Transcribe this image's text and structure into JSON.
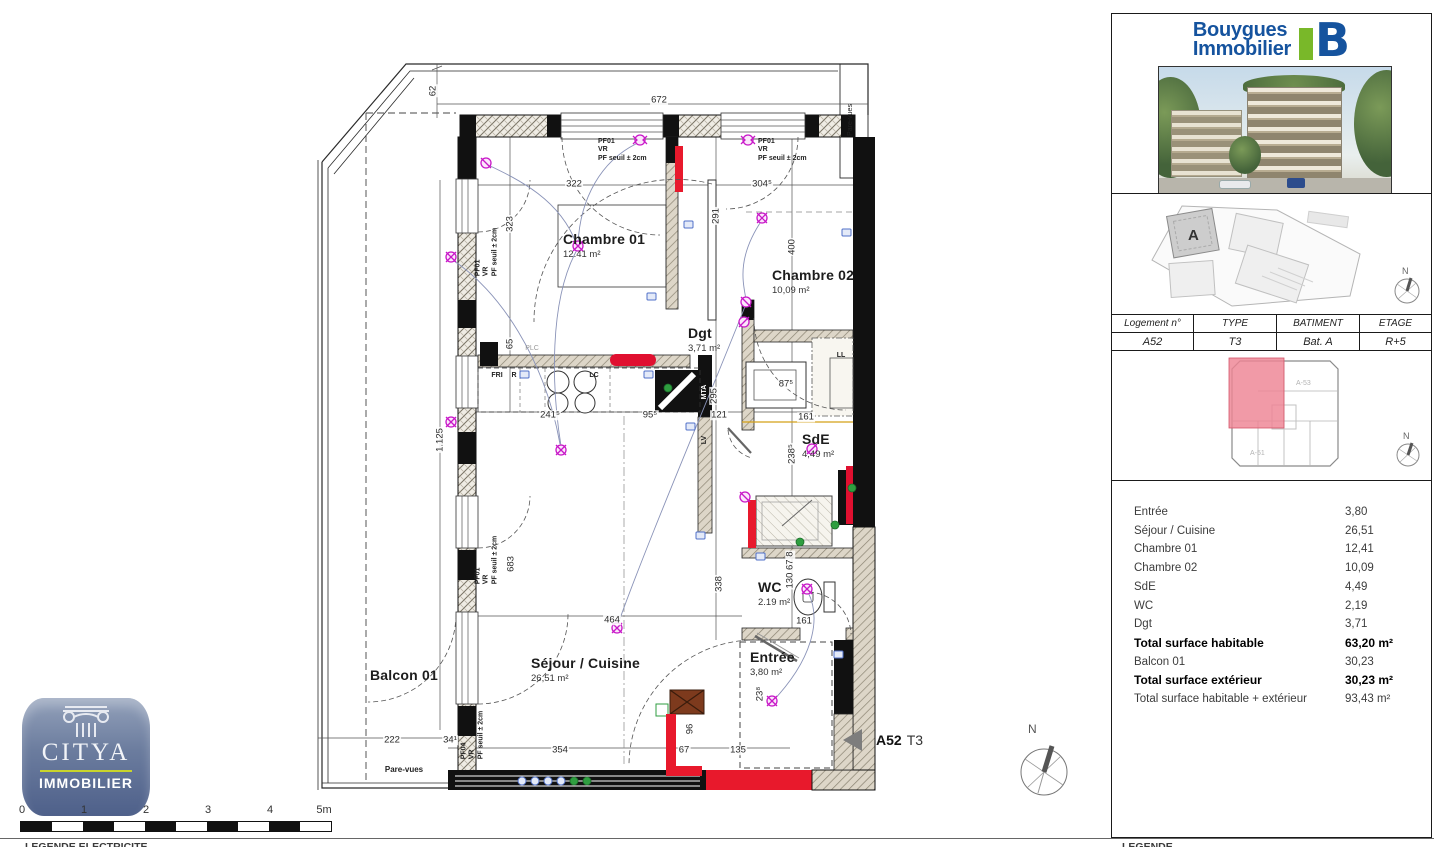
{
  "icons": {
    "bouygues_b": "B",
    "compass_north": "N",
    "triangle_left": "left-pointing triangle"
  },
  "brand": {
    "line1": "Bouygues",
    "line2": "Immobilier"
  },
  "sidebar": {
    "unit_table": {
      "headers": [
        "Logement n°",
        "TYPE",
        "BATIMENT",
        "ETAGE"
      ],
      "values": [
        "A52",
        "T3",
        "Bat. A",
        "R+5"
      ]
    },
    "site_plan": {
      "building_label": "A"
    },
    "key_plan": {
      "units": [
        "A-53",
        "A-51"
      ]
    },
    "areas": {
      "rows": [
        {
          "label": "Entrée",
          "value": "3,80"
        },
        {
          "label": "Séjour / Cuisine",
          "value": "26,51"
        },
        {
          "label": "Chambre 01",
          "value": "12,41"
        },
        {
          "label": "Chambre 02",
          "value": "10,09"
        },
        {
          "label": "SdE",
          "value": "4,49"
        },
        {
          "label": "WC",
          "value": "2,19"
        },
        {
          "label": "Dgt",
          "value": "3,71"
        },
        {
          "label": "Total surface habitable",
          "value": "63,20 m²"
        },
        {
          "label": "Balcon 01",
          "value": "30,23"
        },
        {
          "label": "Total surface extérieur",
          "value": "30,23 m²"
        },
        {
          "label": "Total surface habitable + extérieur",
          "value": "93,43 m²"
        }
      ]
    }
  },
  "plan": {
    "marker": {
      "unit": "A52",
      "type": "T3"
    },
    "rooms": [
      {
        "name": "Chambre 01",
        "area": "12.41 m²"
      },
      {
        "name": "Chambre 02",
        "area": "10,09 m²"
      },
      {
        "name": "Dgt",
        "area": "3,71 m²"
      },
      {
        "name": "SdE",
        "area": "4,49 m²"
      },
      {
        "name": "WC",
        "area": "2.19 m²"
      },
      {
        "name": "Séjour / Cuisine",
        "area": "26,51 m²"
      },
      {
        "name": "Entrée",
        "area": "3,80 m²"
      },
      {
        "name": "Balcon 01",
        "area": ""
      }
    ],
    "dims": [
      "62",
      "672",
      "322",
      "304⁵",
      "323",
      "291",
      "400",
      "65",
      "1.125",
      "241⁵",
      "95⁵",
      "121",
      "161",
      "87⁵",
      "295",
      "238⁵",
      "683",
      "338",
      "464",
      "130 67 8",
      "161",
      "222",
      "34¹",
      "354",
      "67",
      "96",
      "135",
      "23⁸"
    ],
    "small_labels": [
      "PF01\nVR\nPF seuil ± 2cm",
      "PF01\nVR\nPF seuil ± 2cm",
      "PF01\nVR\nPF seuil ± 2cm",
      "PF01\nVR\nPF seuil ± 2cm",
      "PF04\nVR\nPF seuil ± 2cm",
      "Pare-vues",
      "Pare-vues",
      "FRI",
      "R",
      "LC",
      "PLC",
      "MTA",
      "LV",
      "LL"
    ]
  },
  "citya": {
    "name": "CITYA",
    "sub": "IMMOBILIER"
  },
  "scalebar": {
    "ticks": [
      "0",
      "1",
      "2",
      "3",
      "4",
      "5m"
    ]
  },
  "footer": {
    "left": "LEGENDE ELECTRICITE",
    "right": "LEGENDE"
  }
}
